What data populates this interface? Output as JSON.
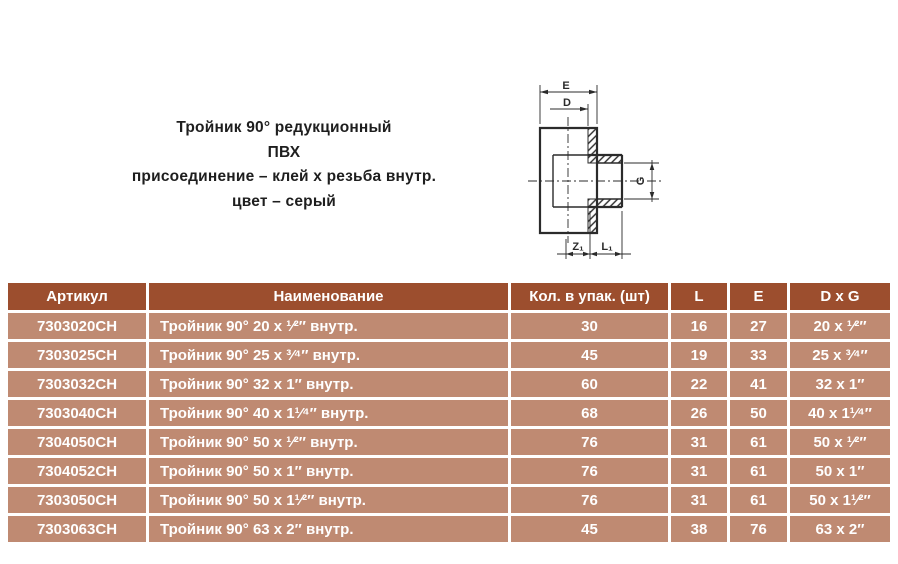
{
  "product": {
    "title_lines": [
      "Тройник 90° редукционный",
      "ПВХ",
      "присоединение – клей х резьба внутр.",
      "цвет – серый"
    ]
  },
  "drawing": {
    "description": "cross-section of 90° reducing tee, glue socket x internal thread",
    "dim_labels": {
      "E": "E",
      "D": "D",
      "G": "G",
      "Z1": "Z₁",
      "L1": "L₁"
    }
  },
  "table": {
    "colors": {
      "header_bg": "#9c4e2e",
      "row_bg": "#bf8a72",
      "text": "#ffffff"
    },
    "headers": [
      "Артикул",
      "Наименование",
      "Кол. в упак. (шт)",
      "L",
      "E",
      "D x G"
    ],
    "rows": [
      [
        "7303020CH",
        "Тройник 90° 20 x ¹⁄²″ внутр.",
        "30",
        "16",
        "27",
        "20 x ¹⁄²″"
      ],
      [
        "7303025CH",
        "Тройник 90° 25 x ³⁄⁴″ внутр.",
        "45",
        "19",
        "33",
        "25 x ³⁄⁴″"
      ],
      [
        "7303032CH",
        "Тройник 90° 32 x 1″ внутр.",
        "60",
        "22",
        "41",
        "32 x 1″"
      ],
      [
        "7303040CH",
        "Тройник 90° 40 x 1¹⁄⁴″ внутр.",
        "68",
        "26",
        "50",
        "40 x 1¹⁄⁴″"
      ],
      [
        "7304050CH",
        "Тройник 90° 50 x ¹⁄²″ внутр.",
        "76",
        "31",
        "61",
        "50 x ¹⁄²″"
      ],
      [
        "7304052CH",
        "Тройник 90° 50 x 1″ внутр.",
        "76",
        "31",
        "61",
        "50 x 1″"
      ],
      [
        "7303050CH",
        "Тройник 90° 50 x 1¹⁄²″ внутр.",
        "76",
        "31",
        "61",
        "50 x 1¹⁄²″"
      ],
      [
        "7303063CH",
        "Тройник 90° 63 x 2″ внутр.",
        "45",
        "38",
        "76",
        "63 x 2″"
      ]
    ]
  }
}
